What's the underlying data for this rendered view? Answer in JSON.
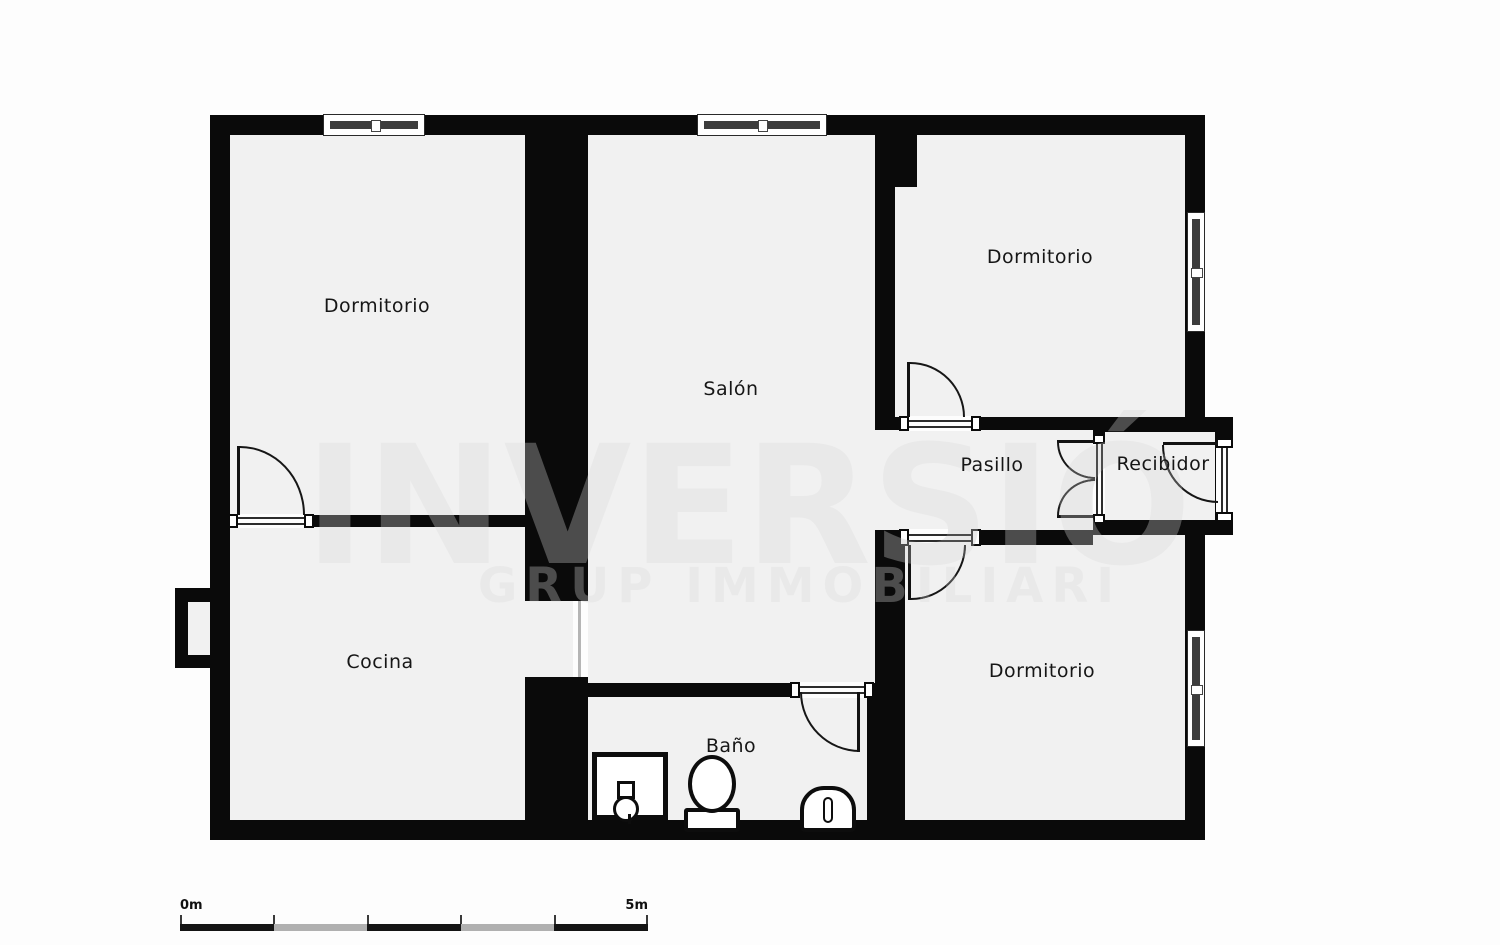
{
  "plan": {
    "rooms": {
      "dormitorio_tl": {
        "label": "Dormitorio"
      },
      "salon": {
        "label": "Salón"
      },
      "dormitorio_tr": {
        "label": "Dormitorio"
      },
      "pasillo": {
        "label": "Pasillo"
      },
      "recibidor": {
        "label": "Recibidor"
      },
      "dormitorio_br": {
        "label": "Dormitorio"
      },
      "cocina": {
        "label": "Cocina"
      },
      "bano": {
        "label": "Baño"
      }
    },
    "watermark": {
      "line1": "INVERSIÓ",
      "line2": "GRUP IMMOBILIARI"
    },
    "scale_bar": {
      "start_label": "0m",
      "end_label": "5m"
    },
    "symbols": {
      "bathroom_fixtures": [
        "sink-unit",
        "toilet",
        "bidet"
      ]
    },
    "colors": {
      "wall": "#0a0a0a",
      "floor": "#f1f1f1",
      "watermark_on_white": "#e9e9e9",
      "watermark_on_black": "#4c4c4c"
    }
  }
}
